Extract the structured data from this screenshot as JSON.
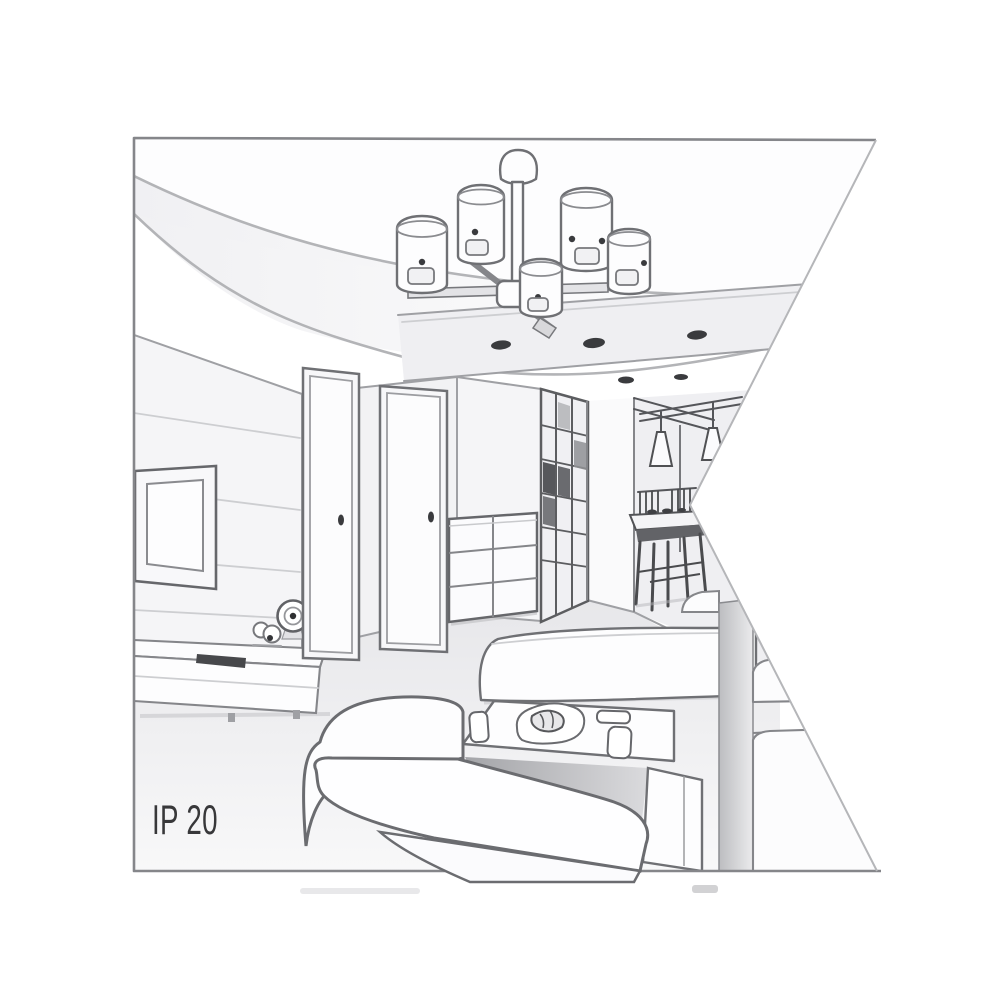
{
  "illustration": {
    "label": "IP 20",
    "scene": {
      "objects": [
        "ceiling chandelier with cylindrical shades",
        "recessed ceiling spotlights",
        "wall-mounted tv",
        "tv sideboard with clock and remote",
        "two interior doors",
        "chest of drawers",
        "glass grid partition",
        "hallway with cone pendant lamps",
        "dining table with chairs",
        "sofas and coffee table with tray"
      ]
    }
  },
  "palette": {
    "background": "#ffffff",
    "line_strong": "#6a6b6f",
    "line_soft": "#9fa0a4",
    "fill_light": "#f3f3f5",
    "fill_mid": "#e7e7ea",
    "shadow": "#b9babd",
    "dark_detail": "#3a3b3e",
    "frame_border": "#85868a",
    "label_text": "#38383a"
  }
}
